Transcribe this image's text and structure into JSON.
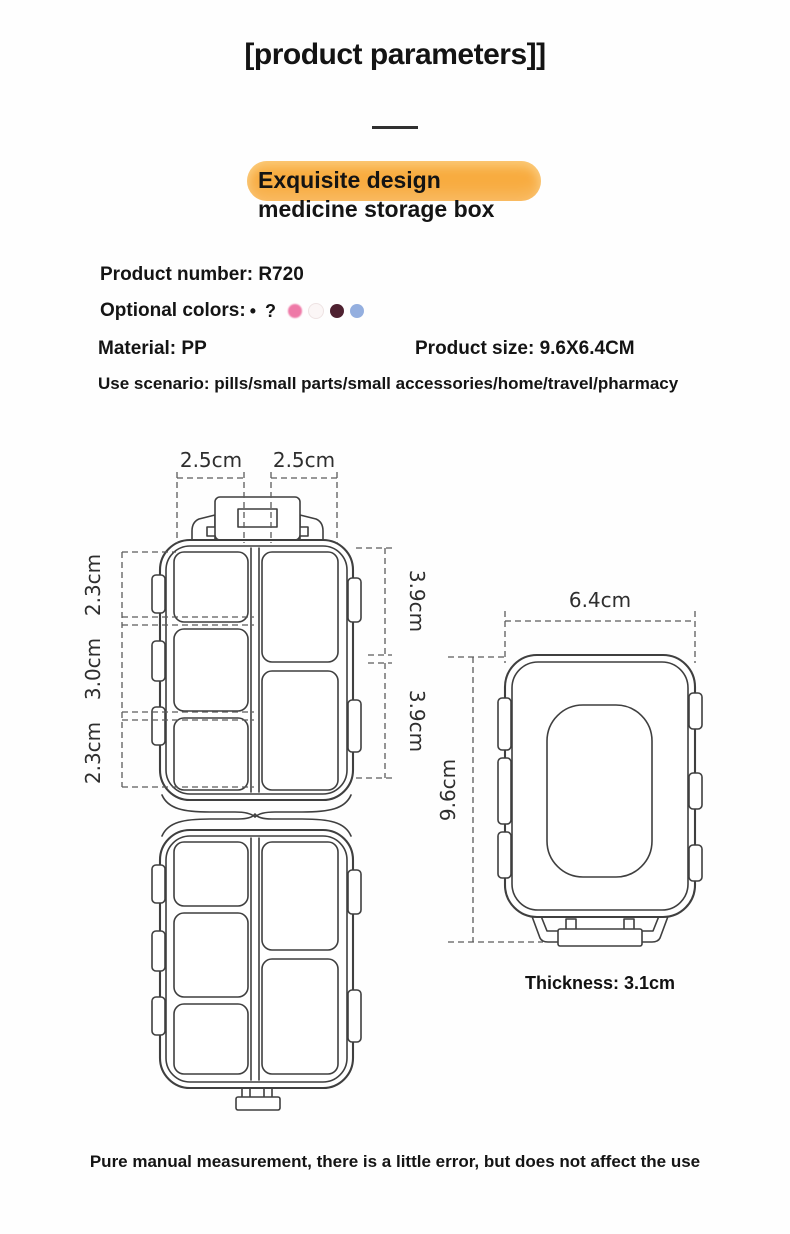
{
  "header": {
    "title": "[product parameters]]"
  },
  "highlight": {
    "line1": "Exquisite design",
    "line2": "medicine storage box",
    "pill_color": "#f8ac40"
  },
  "specs": {
    "product_number": "Product number: R720",
    "optional_colors_label": "Optional colors:",
    "optional_colors_marks": "• ?",
    "swatches": [
      {
        "name": "pink",
        "hex": "#ee79a7"
      },
      {
        "name": "white",
        "hex": "#fbf6f6"
      },
      {
        "name": "dark-maroon",
        "hex": "#4e2130"
      },
      {
        "name": "light-blue",
        "hex": "#94afdf"
      }
    ],
    "material": "Material: PP",
    "product_size": "Product size: 9.6X6.4CM",
    "use_scenario": "Use scenario: pills/small parts/small accessories/home/travel/pharmacy"
  },
  "open_box_diagram": {
    "top_width_left": "2.5cm",
    "top_width_right": "2.5cm",
    "left_top": "2.3cm",
    "left_middle": "3.0cm",
    "left_bottom": "2.3cm",
    "right_top": "3.9cm",
    "right_bottom": "3.9cm"
  },
  "closed_box_diagram": {
    "width": "6.4cm",
    "height": "9.6cm",
    "thickness": "Thickness: 3.1cm"
  },
  "footer": {
    "note": "Pure manual measurement, there is a little error, but does not affect the use"
  }
}
